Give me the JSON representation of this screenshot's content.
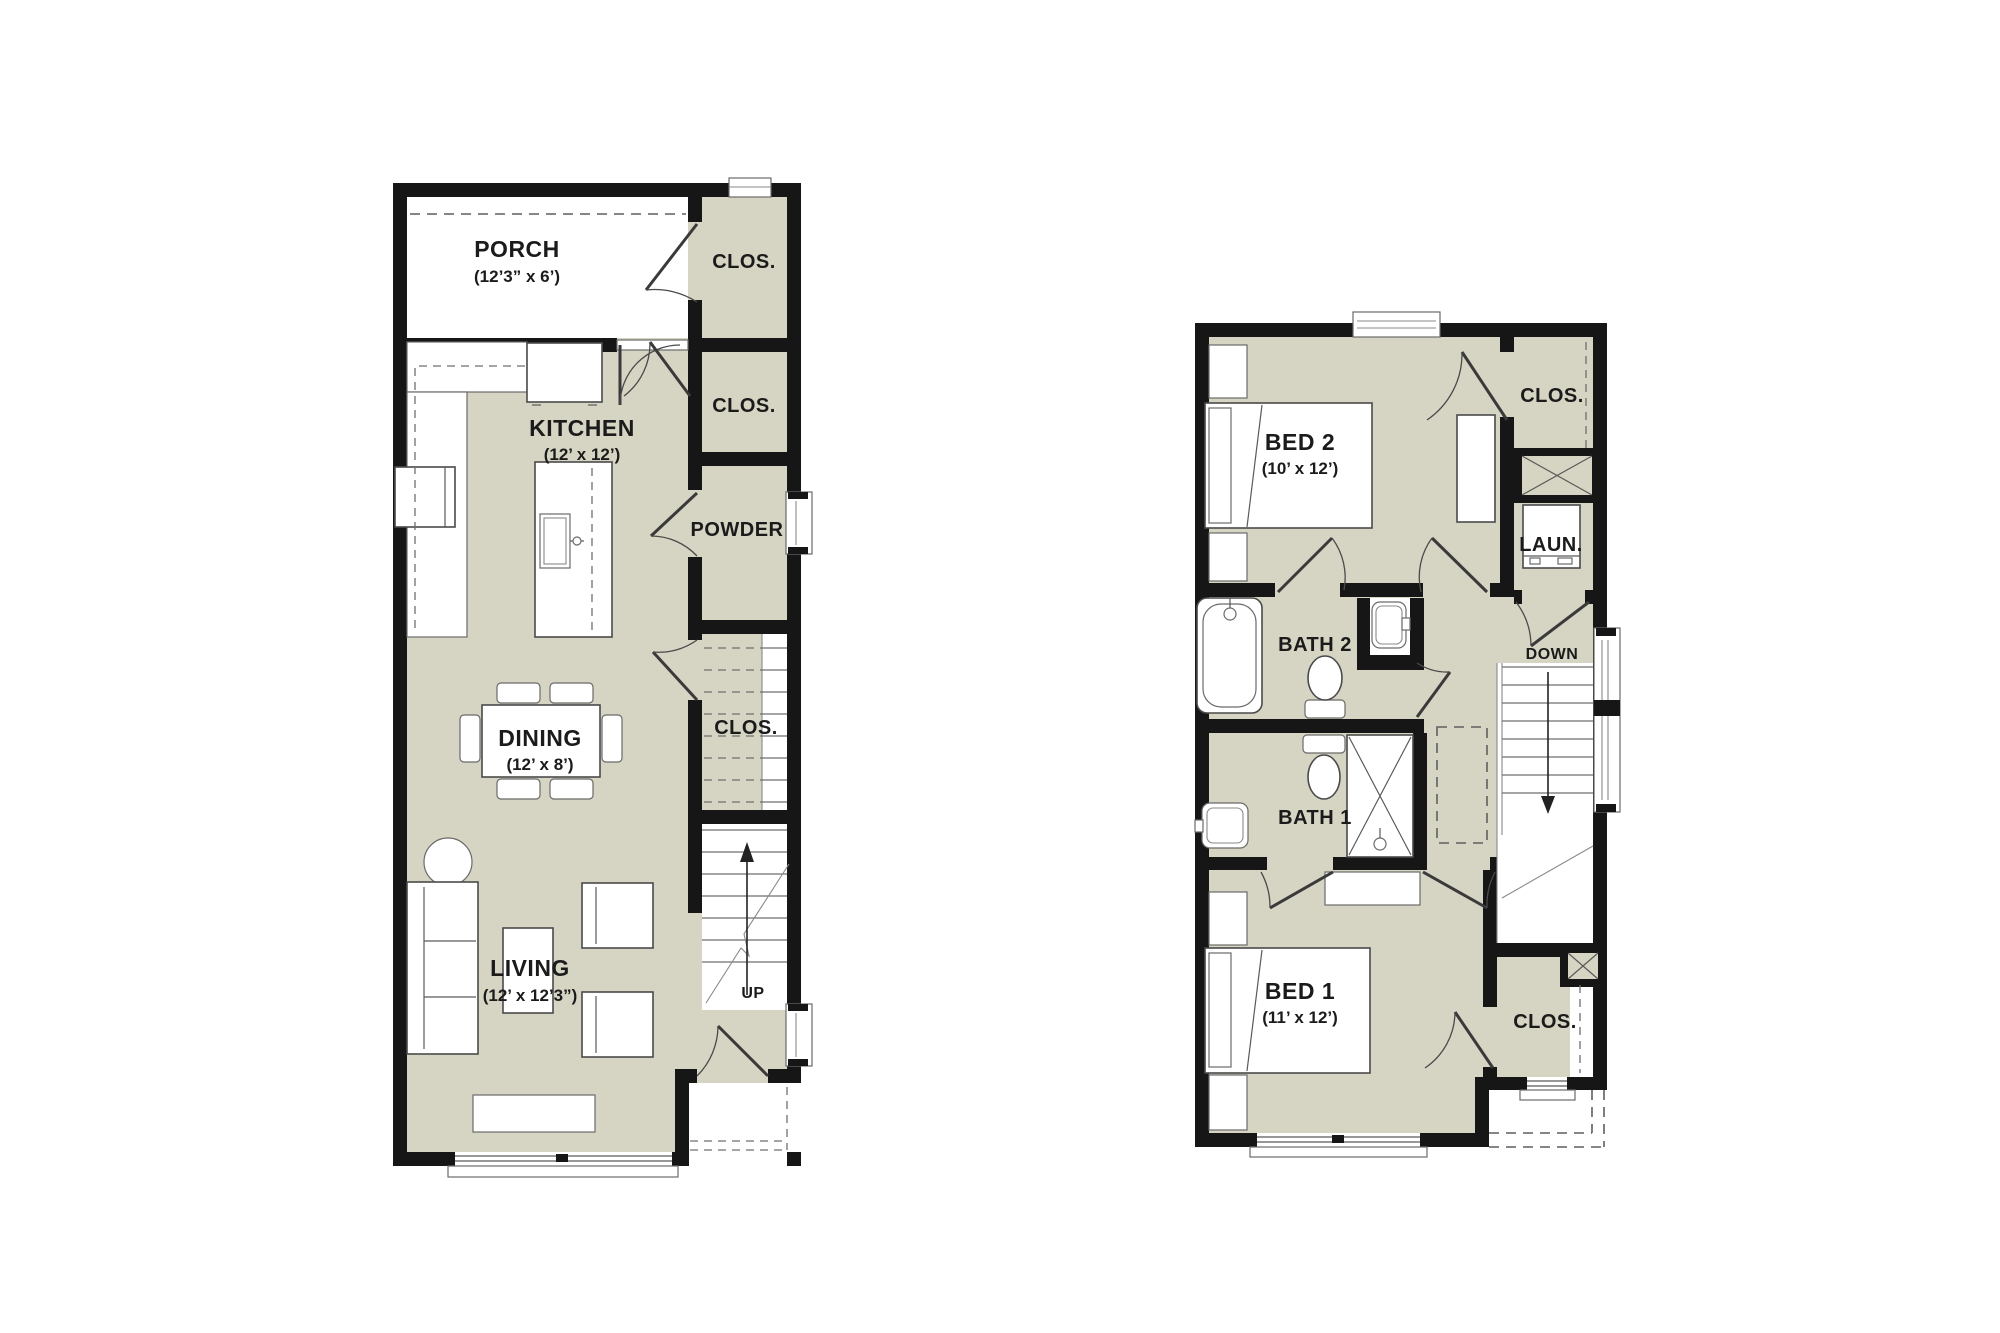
{
  "document": {
    "type": "floor-plan",
    "floors": 2
  },
  "colors": {
    "room_fill": "#d6d4c2",
    "wall": "#161616",
    "paper": "#ffffff",
    "thin_line": "#5a5a5a",
    "text": "#1b1b1b"
  },
  "floor1": {
    "porch": {
      "name": "PORCH",
      "dims": "(12’3” x 6’)"
    },
    "closet_top": {
      "name": "CLOS."
    },
    "closet_mid": {
      "name": "CLOS."
    },
    "kitchen": {
      "name": "KITCHEN",
      "dims": "(12’ x 12’)"
    },
    "powder": {
      "name": "POWDER"
    },
    "dining": {
      "name": "DINING",
      "dims": "(12’ x 8’)"
    },
    "closet_stair": {
      "name": "CLOS."
    },
    "living": {
      "name": "LIVING",
      "dims": "(12’ x 12’3”)"
    },
    "stairs": {
      "direction": "UP"
    }
  },
  "floor2": {
    "bed2": {
      "name": "BED 2",
      "dims": "(10’ x 12’)"
    },
    "closet_bed2": {
      "name": "CLOS."
    },
    "laundry": {
      "name": "LAUN."
    },
    "bath2": {
      "name": "BATH 2"
    },
    "bath1": {
      "name": "BATH 1"
    },
    "stairs": {
      "direction": "DOWN"
    },
    "bed1": {
      "name": "BED 1",
      "dims": "(11’ x 12’)"
    },
    "closet_bed1": {
      "name": "CLOS."
    }
  }
}
